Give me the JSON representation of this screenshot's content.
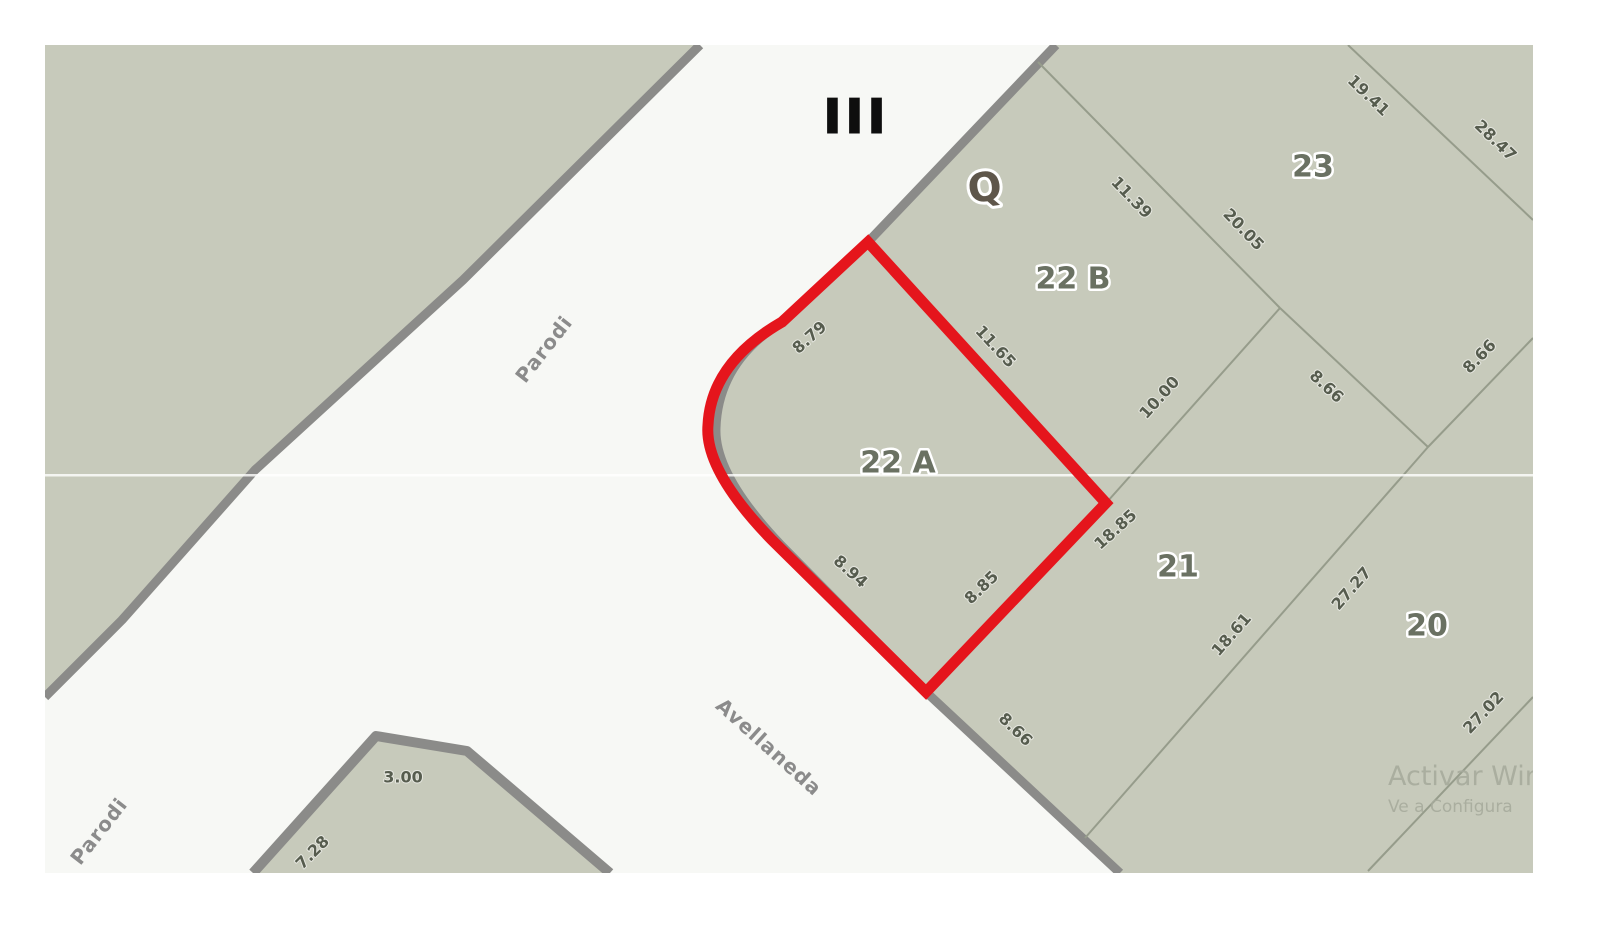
{
  "marks": {
    "section": "III",
    "block": "Q"
  },
  "streets": {
    "parodi_upper": "Parodi",
    "parodi_lower": "Parodi",
    "avellaneda": "Avellaneda"
  },
  "lots": {
    "l23": "23",
    "l22b": "22 B",
    "l22a": "22 A",
    "l21": "21",
    "l20": "20"
  },
  "highlighted_lot": "22 A",
  "meas": {
    "s879": "8.79",
    "s1165": "11.65",
    "s1139": "11.39",
    "s2005": "20.05",
    "s1941": "19.41",
    "s2847": "28.47",
    "s1000": "10.00",
    "s866w": "8.66",
    "s866e": "8.66",
    "s1885": "18.85",
    "s885": "8.85",
    "s894": "8.94",
    "s866s": "8.66",
    "s1861": "18.61",
    "s2727": "27.27",
    "s2702": "27.02",
    "s300": "3.00",
    "s728": "7.28"
  },
  "watermark": {
    "line1": "Activar Win",
    "line2": "Ve a Configura"
  },
  "colors": {
    "parcel_fill": "#c7cabb",
    "street_fill": "#f7f8f5",
    "road_edge": "#8b8b89",
    "boundary_line": "#969c8b",
    "label_text": "#565c4e",
    "lot_text": "#6a7162",
    "street_label": "#8b8b8b",
    "block_letter_color": "#5e564a",
    "section_color": "#0e0e0e",
    "highlight": "#e5151c",
    "watermark_color": "#a7ab9d",
    "seam_line": "#ffffff"
  }
}
